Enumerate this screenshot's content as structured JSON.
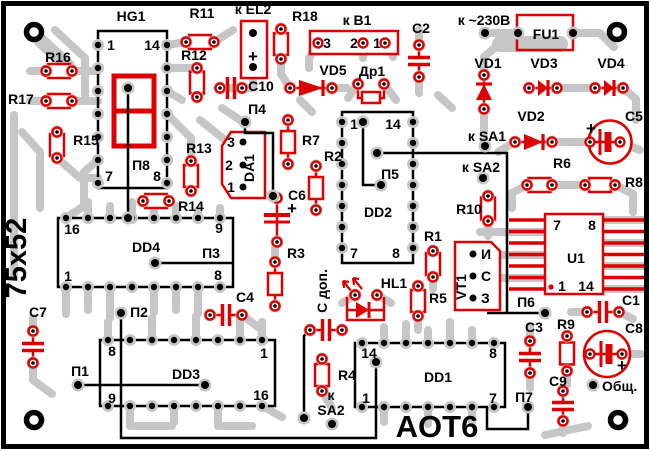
{
  "board": {
    "colors": {
      "background": "#ffffff",
      "copper_trace": "#c6c6c6",
      "component_outline": "#dd0000",
      "silkscreen": "#000000"
    }
  },
  "labels": {
    "hg1": "HG1",
    "hg1_p1": "1",
    "hg1_p14": "14",
    "hg1_p7": "7",
    "hg1_p8": "8",
    "p8": "П8",
    "r1": "R1",
    "r2": "R2",
    "r3": "R3",
    "r4": "R4",
    "r5": "R5",
    "r6": "R6",
    "r7": "R7",
    "r8": "R8",
    "r9": "R9",
    "r10": "R10",
    "r11": "R11",
    "r12": "R12",
    "r13": "R13",
    "r14": "R14",
    "r15": "R15",
    "r16": "R16",
    "r17": "R17",
    "r18": "R18",
    "c1": "C1",
    "c2": "C2",
    "c3": "C3",
    "c4": "C4",
    "c5": "C5",
    "c6": "C6",
    "c7": "C7",
    "c8": "C8",
    "c9": "C9",
    "c10": "C10",
    "c_dop": "С доп.",
    "vd1": "VD1",
    "vd2": "VD2",
    "vd3": "VD3",
    "vd4": "VD4",
    "vd5": "VD5",
    "dr1": "Др1",
    "hl1": "HL1",
    "da1": "DA1",
    "da1_3": "3",
    "da1_2": "2",
    "da1_1": "1",
    "vt1": "VT1",
    "vt1_i": "И",
    "vt1_s": "С",
    "vt1_z": "З",
    "u1": "U1",
    "u1_p7": "7",
    "u1_p8": "8",
    "u1_p1": "1",
    "u1_p14": "14",
    "dd1": "DD1",
    "dd1_p14": "14",
    "dd1_p8": "8",
    "dd1_p1": "1",
    "dd1_p7": "7",
    "dd2": "DD2",
    "dd2_p1": "1",
    "dd2_p14": "14",
    "dd2_p7": "7",
    "dd2_p8": "8",
    "dd3": "DD3",
    "dd3_p8": "8",
    "dd3_p1": "1",
    "dd3_p9": "9",
    "dd3_p16": "16",
    "dd4": "DD4",
    "dd4_p16": "16",
    "dd4_p9": "9",
    "dd4_p1": "1",
    "dd4_p8": "8",
    "fu1": "FU1",
    "k_230": "к ~230В",
    "k_el2": "к EL2",
    "k_b1": "к В1",
    "b1_3": "3",
    "b1_2": "2",
    "b1_1": "1",
    "k_sa1": "к SA1",
    "k_sa2": "к SA2",
    "k_small": "к",
    "sa2": "SA2",
    "p1": "П1",
    "p2": "П2",
    "p3": "П3",
    "p4": "П4",
    "p5": "П5",
    "p6": "П6",
    "p7": "П7",
    "obsh": "Общ.",
    "plus": "+",
    "size": "75x52",
    "board_name": "AOT6"
  }
}
